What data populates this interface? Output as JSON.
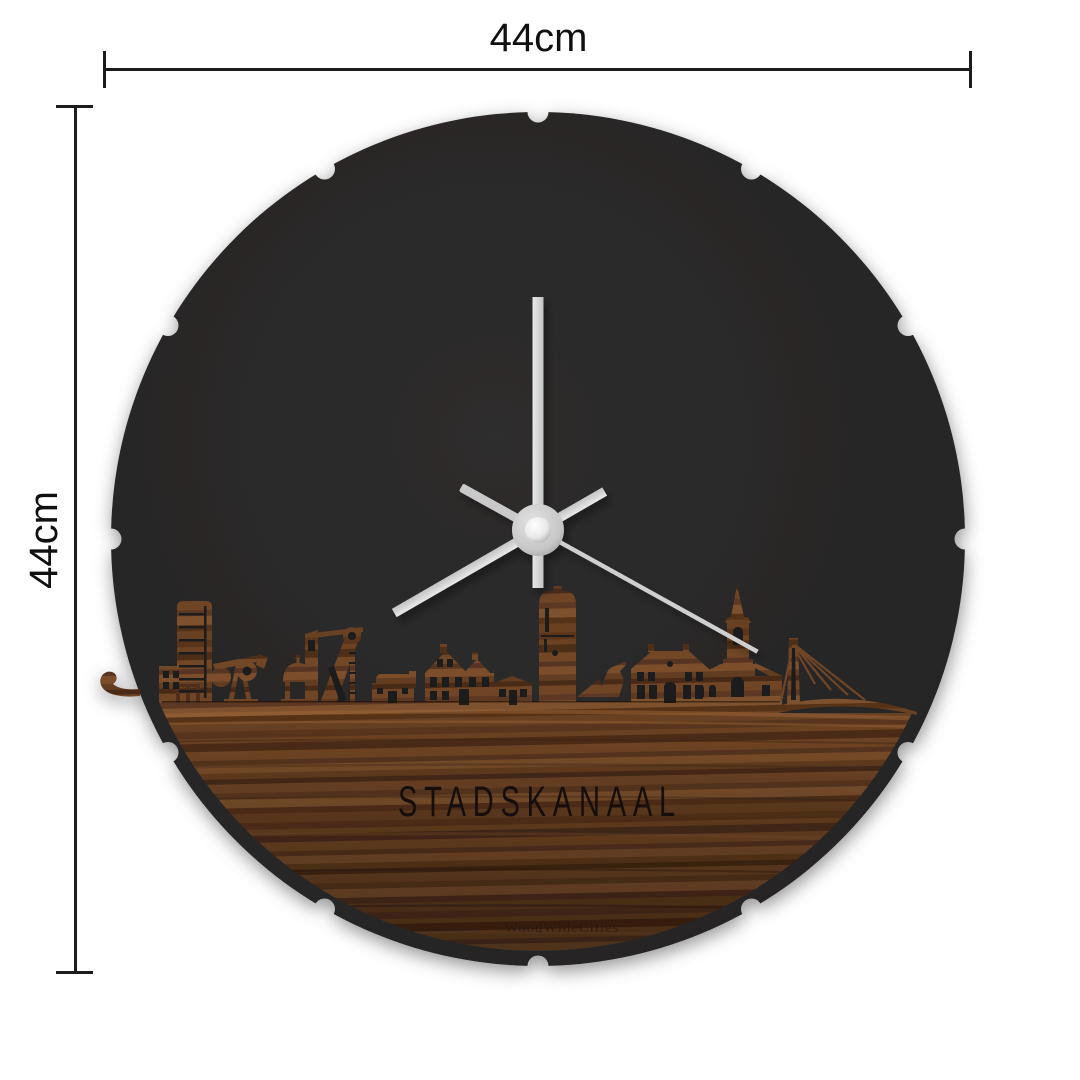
{
  "annotations": {
    "width_label": "44cm",
    "height_label": "44cm"
  },
  "clock": {
    "city_name": "STADSKANAAL",
    "watermark": "WoodWideCities",
    "time_shown": "8:00:20",
    "rim_notch_count": 12,
    "colors": {
      "background": "#ffffff",
      "face": "#282727",
      "wood": "#6b4226",
      "hands": "#d9d9d9",
      "dimension_lines": "#1c1c1c",
      "engraved_text": "#150d08"
    }
  }
}
